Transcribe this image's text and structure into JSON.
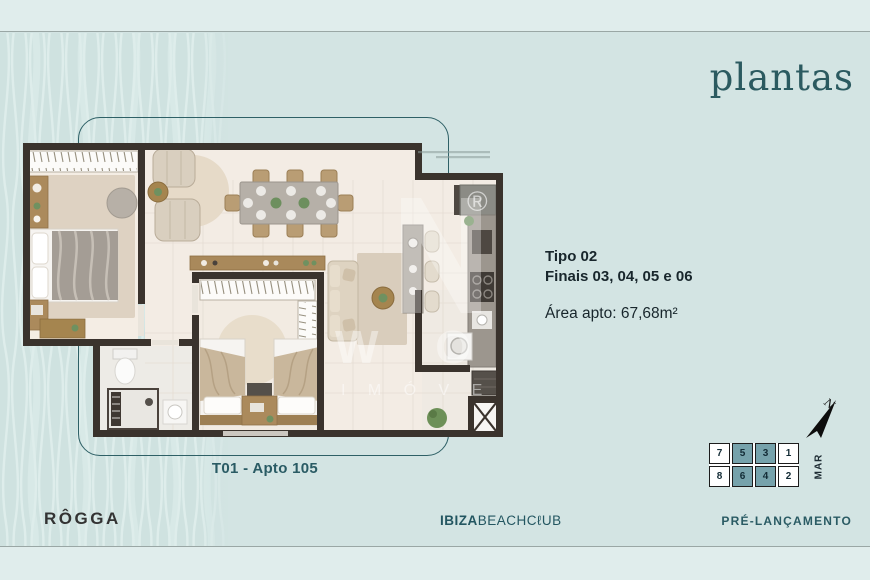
{
  "header": {
    "page_title": "plantas"
  },
  "unit_info": {
    "type": "Tipo 02",
    "units": "Finais 03, 04, 05 e 06",
    "area": "Área apto: 67,68m²"
  },
  "plan": {
    "caption": "T01 - Apto 105",
    "watermark_symbol": "®",
    "watermark_letters": "W O L F",
    "watermark_word": "I M Ó V E"
  },
  "site_map": {
    "rows": [
      [
        "7",
        "5",
        "3",
        "1"
      ],
      [
        "8",
        "6",
        "4",
        "2"
      ]
    ],
    "highlighted_units": [
      "5",
      "3",
      "6",
      "4"
    ],
    "sea_label": "MAR",
    "north_label": "N"
  },
  "footer": {
    "brand": "RÔGGA",
    "development_bold": "IBIZA",
    "development_light": "BEACHCℓUB",
    "launch_status": "PRÉ-LANÇAMENTO"
  },
  "colors": {
    "background": "#d3e4e3",
    "band": "#e0edec",
    "accent_teal": "#2b5a60",
    "wall": "#3a332d",
    "unit_highlight": "#76a2ab"
  }
}
